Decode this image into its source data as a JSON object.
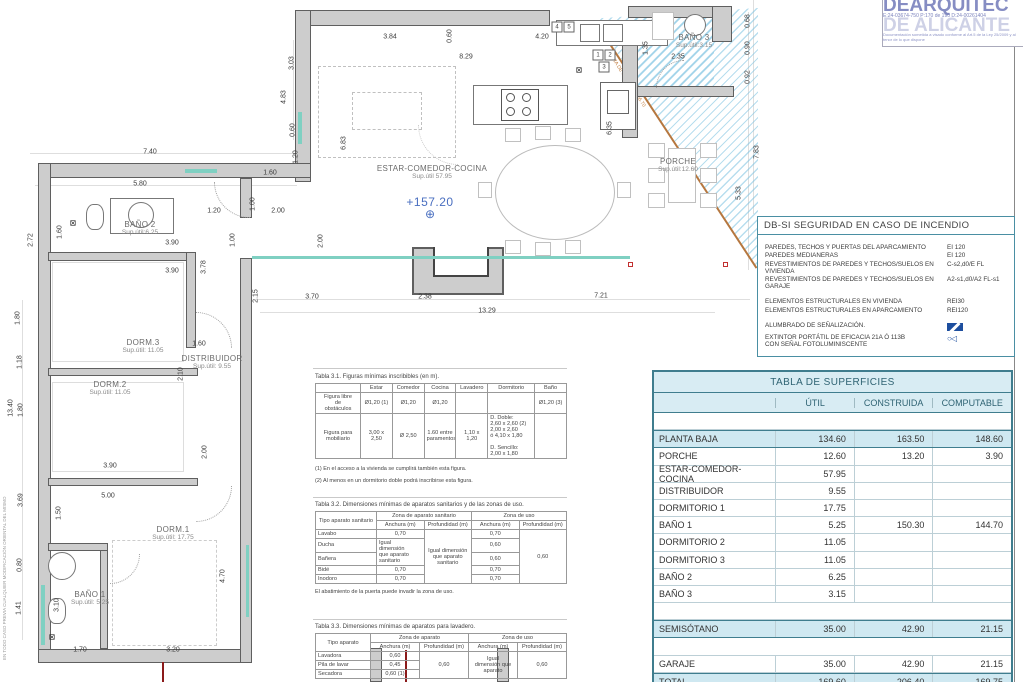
{
  "stamp": {
    "title": "DEARQUITEC",
    "subtitle": "DE ALICANTE",
    "line1": "E:24-03674-750      P:170 de 190      D:24-00261404",
    "line2": "Documentación sometida a visado conforme al Art.5 de la Ley 25/2009 y al tenor de lo que dispone"
  },
  "plan": {
    "level_mark": "+157.20",
    "level_cross": "⊕",
    "diag_note": "COTA DE SÓTANO +156.70",
    "margin_note": "EN TODO CASO PREVIA CUALQUIER MODIFICACIÓN ORIENTAL DEL MISMO",
    "fan_symbol": "⊠",
    "rooms": [
      {
        "n": "BAÑO 2",
        "s": "Sup.útil:6.25",
        "x": 140,
        "y": 228
      },
      {
        "n": "DORM.3",
        "s": "Sup.útil: 11.05",
        "x": 143,
        "y": 346
      },
      {
        "n": "DISTRIBUIDOR",
        "s": "Sup.útil: 9.55",
        "x": 212,
        "y": 362
      },
      {
        "n": "DORM.2",
        "s": "Sup.útil: 11.05",
        "x": 110,
        "y": 388
      },
      {
        "n": "DORM.1",
        "s": "Sup.útil: 17.75",
        "x": 173,
        "y": 533
      },
      {
        "n": "BAÑO 1",
        "s": "Sup.útil: 5.25",
        "x": 90,
        "y": 598
      },
      {
        "n": "ESTAR-COMEDOR-COCINA",
        "s": "Sup.útil 57.95",
        "x": 432,
        "y": 172
      },
      {
        "n": "PORCHE",
        "s": "Sup.útil:12.60",
        "x": 678,
        "y": 165
      },
      {
        "n": "BAÑO 3",
        "s": "Sup.útil:3.15",
        "x": 694,
        "y": 41
      }
    ],
    "dims": [
      {
        "t": "7.40",
        "x": 150,
        "y": 152
      },
      {
        "t": "5.80",
        "x": 140,
        "y": 184
      },
      {
        "t": "1.20",
        "x": 296,
        "y": 157,
        "v": 1
      },
      {
        "t": "1.60",
        "x": 270,
        "y": 173
      },
      {
        "t": "3.84",
        "x": 390,
        "y": 37
      },
      {
        "t": "0.60",
        "x": 450,
        "y": 36,
        "v": 1
      },
      {
        "t": "8.29",
        "x": 466,
        "y": 57
      },
      {
        "t": "4.20",
        "x": 542,
        "y": 37
      },
      {
        "t": "3.03",
        "x": 292,
        "y": 63,
        "v": 1
      },
      {
        "t": "4.83",
        "x": 284,
        "y": 97,
        "v": 1
      },
      {
        "t": "0.60",
        "x": 293,
        "y": 130,
        "v": 1
      },
      {
        "t": "6.83",
        "x": 344,
        "y": 143,
        "v": 1
      },
      {
        "t": "6.35",
        "x": 610,
        "y": 128,
        "v": 1
      },
      {
        "t": "1.35",
        "x": 646,
        "y": 48,
        "v": 1
      },
      {
        "t": "2.35",
        "x": 678,
        "y": 57
      },
      {
        "t": "0.68",
        "x": 748,
        "y": 21,
        "v": 1
      },
      {
        "t": "0.90",
        "x": 748,
        "y": 48,
        "v": 1
      },
      {
        "t": "0.92",
        "x": 748,
        "y": 77,
        "v": 1
      },
      {
        "t": "7.83",
        "x": 757,
        "y": 152,
        "v": 1
      },
      {
        "t": "5.33",
        "x": 739,
        "y": 193,
        "v": 1
      },
      {
        "t": "2.72",
        "x": 31,
        "y": 240,
        "v": 1
      },
      {
        "t": "1.60",
        "x": 60,
        "y": 232,
        "v": 1
      },
      {
        "t": "3.90",
        "x": 172,
        "y": 243
      },
      {
        "t": "3.90",
        "x": 172,
        "y": 271
      },
      {
        "t": "1.20",
        "x": 214,
        "y": 211
      },
      {
        "t": "1.00",
        "x": 253,
        "y": 204,
        "v": 1
      },
      {
        "t": "2.00",
        "x": 278,
        "y": 211
      },
      {
        "t": "1.00",
        "x": 233,
        "y": 240,
        "v": 1
      },
      {
        "t": "2.00",
        "x": 321,
        "y": 241,
        "v": 1
      },
      {
        "t": "3.78",
        "x": 204,
        "y": 267,
        "v": 1
      },
      {
        "t": "1.80",
        "x": 18,
        "y": 318,
        "v": 1
      },
      {
        "t": "1.60",
        "x": 199,
        "y": 344
      },
      {
        "t": "2.10",
        "x": 181,
        "y": 374,
        "v": 1
      },
      {
        "t": "1.18",
        "x": 20,
        "y": 362,
        "v": 1
      },
      {
        "t": "13.40",
        "x": 11,
        "y": 408,
        "v": 1
      },
      {
        "t": "1.80",
        "x": 21,
        "y": 410,
        "v": 1
      },
      {
        "t": "3.90",
        "x": 110,
        "y": 466
      },
      {
        "t": "2.00",
        "x": 205,
        "y": 452,
        "v": 1
      },
      {
        "t": "3.69",
        "x": 21,
        "y": 500,
        "v": 1
      },
      {
        "t": "5.00",
        "x": 108,
        "y": 496
      },
      {
        "t": "1.50",
        "x": 59,
        "y": 513,
        "v": 1
      },
      {
        "t": "3.10",
        "x": 57,
        "y": 605,
        "v": 1
      },
      {
        "t": "0.80",
        "x": 20,
        "y": 565,
        "v": 1
      },
      {
        "t": "1.41",
        "x": 19,
        "y": 608,
        "v": 1
      },
      {
        "t": "4.70",
        "x": 223,
        "y": 576,
        "v": 1
      },
      {
        "t": "1.70",
        "x": 80,
        "y": 650
      },
      {
        "t": "3.20",
        "x": 173,
        "y": 650
      },
      {
        "t": "2.15",
        "x": 256,
        "y": 296,
        "v": 1
      },
      {
        "t": "3.70",
        "x": 312,
        "y": 297
      },
      {
        "t": "2.38",
        "x": 425,
        "y": 297
      },
      {
        "t": "7.21",
        "x": 601,
        "y": 296
      },
      {
        "t": "13.29",
        "x": 487,
        "y": 311
      }
    ],
    "tags": [
      {
        "t": "4",
        "x": 557,
        "y": 27
      },
      {
        "t": "5",
        "x": 569,
        "y": 27
      },
      {
        "t": "1",
        "x": 598,
        "y": 55
      },
      {
        "t": "2",
        "x": 610,
        "y": 55
      },
      {
        "t": "3",
        "x": 604,
        "y": 67
      }
    ]
  },
  "fire_safety": {
    "title": "DB-SI   SEGURIDAD EN CASO DE INCENDIO",
    "group1": [
      {
        "label": "Paredes, techos y puertas del aparcamiento",
        "value": "EI 120"
      },
      {
        "label": "Paredes medianeras",
        "value": "EI 120"
      },
      {
        "label": "Revestimientos de paredes y techos/suelos en vivienda",
        "value": "C-s2,d0/E  FL"
      },
      {
        "label": "Revestimientos de paredes y techos/suelos en garaje",
        "value": "A2-s1,d0/A2 FL-s1"
      }
    ],
    "group2": [
      {
        "label": "Elementos estructurales en vivienda",
        "value": "REI30"
      },
      {
        "label": "Elementos estructurales en aparcamiento",
        "value": "REI120"
      }
    ],
    "group3": [
      {
        "label": "Alumbrado de señalización.",
        "cls": "exit"
      },
      {
        "label": "Extintor portátil de eficacia 21A ó 113B\ncon señal fotoluminiscente",
        "cls": "ext"
      }
    ]
  },
  "surfaces": {
    "title": "TABLA DE SUPERFICIES",
    "col_util": "ÚTIL",
    "col_construida": "CONSTRUIDA",
    "col_computable": "COMPUTABLE",
    "rows": [
      {
        "label": "",
        "util": "",
        "cons": "",
        "comp": "",
        "cls": "sp"
      },
      {
        "label": "PLANTA  BAJA",
        "util": "134.60",
        "cons": "163.50",
        "comp": "148.60",
        "cls": "hl"
      },
      {
        "label": "PORCHE",
        "util": "12.60",
        "cons": "13.20",
        "comp": "3.90"
      },
      {
        "label": "ESTAR-COMEDOR-COCINA",
        "util": "57.95",
        "cons": "",
        "comp": ""
      },
      {
        "label": "DISTRIBUIDOR",
        "util": "9.55",
        "cons": "",
        "comp": ""
      },
      {
        "label": "DORMITORIO 1",
        "util": "17.75",
        "cons": "",
        "comp": ""
      },
      {
        "label": "BAÑO 1",
        "util": "5.25",
        "cons": "150.30",
        "comp": "144.70"
      },
      {
        "label": "DORMITORIO 2",
        "util": "11.05",
        "cons": "",
        "comp": ""
      },
      {
        "label": "DORMITORIO 3",
        "util": "11.05",
        "cons": "",
        "comp": ""
      },
      {
        "label": "BAÑO 2",
        "util": "6.25",
        "cons": "",
        "comp": ""
      },
      {
        "label": "BAÑO 3",
        "util": "3.15",
        "cons": "",
        "comp": ""
      },
      {
        "label": "",
        "util": "",
        "cons": "",
        "comp": "",
        "cls": "sp"
      },
      {
        "label": "SEMISÓTANO",
        "util": "35.00",
        "cons": "42.90",
        "comp": "21.15",
        "cls": "hl"
      },
      {
        "label": "",
        "util": "",
        "cons": "",
        "comp": "",
        "cls": "sp"
      },
      {
        "label": "GARAJE",
        "util": "35.00",
        "cons": "42.90",
        "comp": "21.15"
      },
      {
        "label": "TOTAL",
        "util": "169.60",
        "cons": "206.40",
        "comp": "169.75",
        "cls": "hl"
      }
    ]
  },
  "tabla31": {
    "caption": "Tabla 3.1. Figuras mínimas inscribibles (en m).",
    "cols": [
      "",
      "Estar",
      "Comedor",
      "Cocina",
      "Lavadero",
      "Dormitorio",
      "Baño"
    ],
    "r1": [
      "Figura libre\nde\nobstáculos",
      "Ø1,20 (1)",
      "Ø1,20",
      "Ø1,20",
      "",
      "",
      "Ø1,20 (3)"
    ],
    "r2": [
      "Figura para\nmobiliario",
      "3,00 x 2,50",
      "Ø 2,50",
      "1.60 entre\nparamentos",
      "1,10 x 1,20",
      "D. Doble:\n2,60 x 2,60 (2)\n2,00 x 2,60\nó 4,10 x 1,80\n\nD. Sencillo:\n2,00 x 1,80",
      ""
    ],
    "note1": "(1) En el acceso a la vivienda se cumplirá también esta figura.",
    "note2": "(2) Al menos en un dormitorio doble podrá inscribirse esta figura."
  },
  "tabla32": {
    "caption": "Tabla 3.2. Dimensiones mínimas de aparatos sanitarios y de las zonas de uso.",
    "h_tipo": "Tipo aparato sanitario",
    "h_zona_aparato": "Zona de aparato sanitario",
    "h_zona_uso": "Zona de uso",
    "h_anchura": "Anchura (m)",
    "h_profundidad": "Profundidad (m)",
    "lavabo": "Lavabo",
    "lavabo_a": "0,70",
    "lavabo_u": "0,70",
    "ducha": "Ducha",
    "ducha_u": "0,60",
    "banera": "Bañera",
    "banera_u": "0,60",
    "bide": "Bidé",
    "bide_a": "0,70",
    "bide_u": "0,70",
    "inodoro": "Inodoro",
    "inodoro_a": "0,70",
    "inodoro_u": "0,70",
    "merge_igual": "Igual\ndimensión\nque aparato\nsanitario",
    "merge_prof": "Igual dimensión\nque aparato\nsanitario",
    "merge_uso_prof": "0,60",
    "note": "El abatimiento de la puerta puede invadir la zona de uso."
  },
  "tabla33": {
    "caption": "Tabla 3.3. Dimensiones mínimas de aparatos para lavadero.",
    "h_tipo": "Tipo aparato",
    "h_zona_aparato": "Zona de aparato",
    "h_zona_uso": "Zona de uso",
    "h_anchura": "Anchura (m)",
    "h_profundidad": "Profundidad (m)",
    "lavadora": "Lavadora",
    "lavadora_a": "0,60",
    "pila": "Pila de lavar",
    "pila_a": "0,45",
    "secadora": "Secadora",
    "secadora_a": "0,60 (1)",
    "merge_prof": "0,60",
    "merge_uso_anch": "Igual\ndimensión que\naparato",
    "merge_uso_prof": "0,60"
  }
}
